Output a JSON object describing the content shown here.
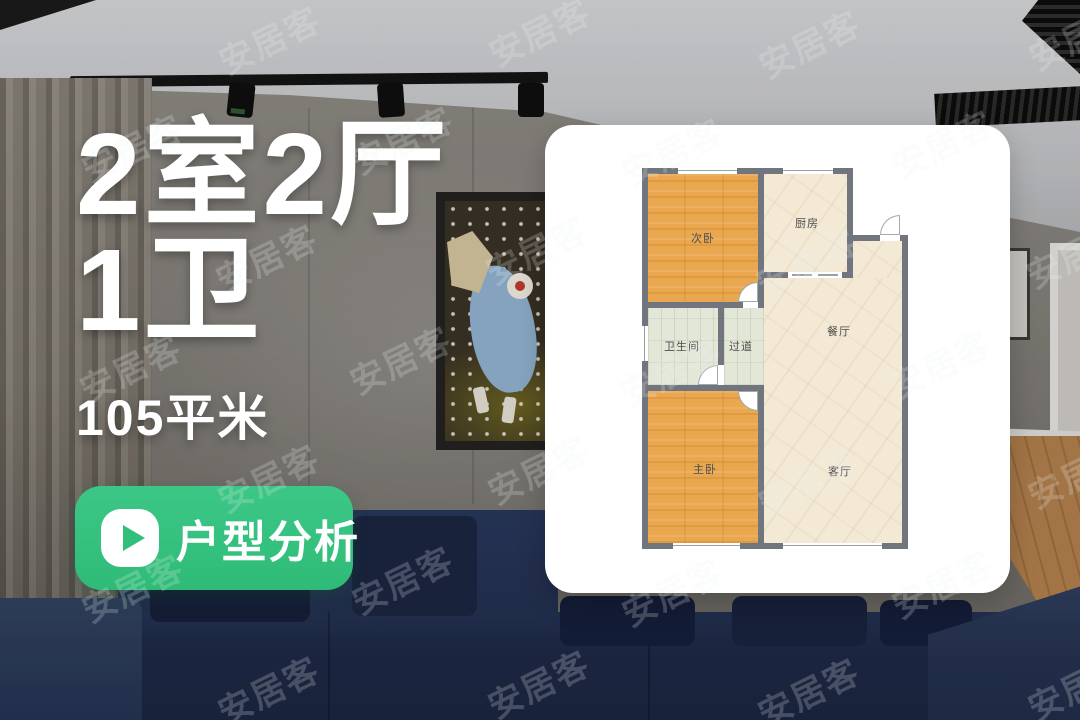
{
  "headline": {
    "line1": "2室2厅",
    "line2": "1卫",
    "area": "105平米"
  },
  "cta": {
    "label": "户型分析",
    "icon": "play-icon",
    "bg_color": "#35c17f"
  },
  "watermark": {
    "text": "安居客",
    "positions": [
      [
        215,
        14
      ],
      [
        485,
        6
      ],
      [
        755,
        18
      ],
      [
        1025,
        10
      ],
      [
        78,
        122
      ],
      [
        348,
        114
      ],
      [
        618,
        126
      ],
      [
        888,
        118
      ],
      [
        212,
        232
      ],
      [
        482,
        224
      ],
      [
        752,
        236
      ],
      [
        1022,
        228
      ],
      [
        76,
        342
      ],
      [
        346,
        334
      ],
      [
        616,
        346
      ],
      [
        886,
        338
      ],
      [
        214,
        452
      ],
      [
        484,
        444
      ],
      [
        754,
        456
      ],
      [
        1024,
        448
      ],
      [
        78,
        562
      ],
      [
        348,
        554
      ],
      [
        618,
        566
      ],
      [
        888,
        558
      ],
      [
        214,
        664
      ],
      [
        484,
        658
      ],
      [
        754,
        666
      ],
      [
        1024,
        660
      ]
    ]
  },
  "floorplan": {
    "rooms": [
      {
        "id": "secondary-bedroom",
        "label": "次卧",
        "floor": "wood-orange"
      },
      {
        "id": "kitchen",
        "label": "厨房",
        "floor": "tile-cream"
      },
      {
        "id": "bathroom",
        "label": "卫生间",
        "floor": "tile-sage"
      },
      {
        "id": "hallway",
        "label": "过道",
        "floor": "tile-sage"
      },
      {
        "id": "dining-room",
        "label": "餐厅",
        "floor": "tile-cream"
      },
      {
        "id": "master-bedroom",
        "label": "主卧",
        "floor": "wood-orange"
      },
      {
        "id": "living-room",
        "label": "客厅",
        "floor": "tile-cream"
      }
    ],
    "colors": {
      "wall": "#70757e",
      "bedroom_floor": "#e9a74f",
      "hall_floor": "#f3e9d5",
      "wet_floor": "#e3e7d8"
    }
  }
}
